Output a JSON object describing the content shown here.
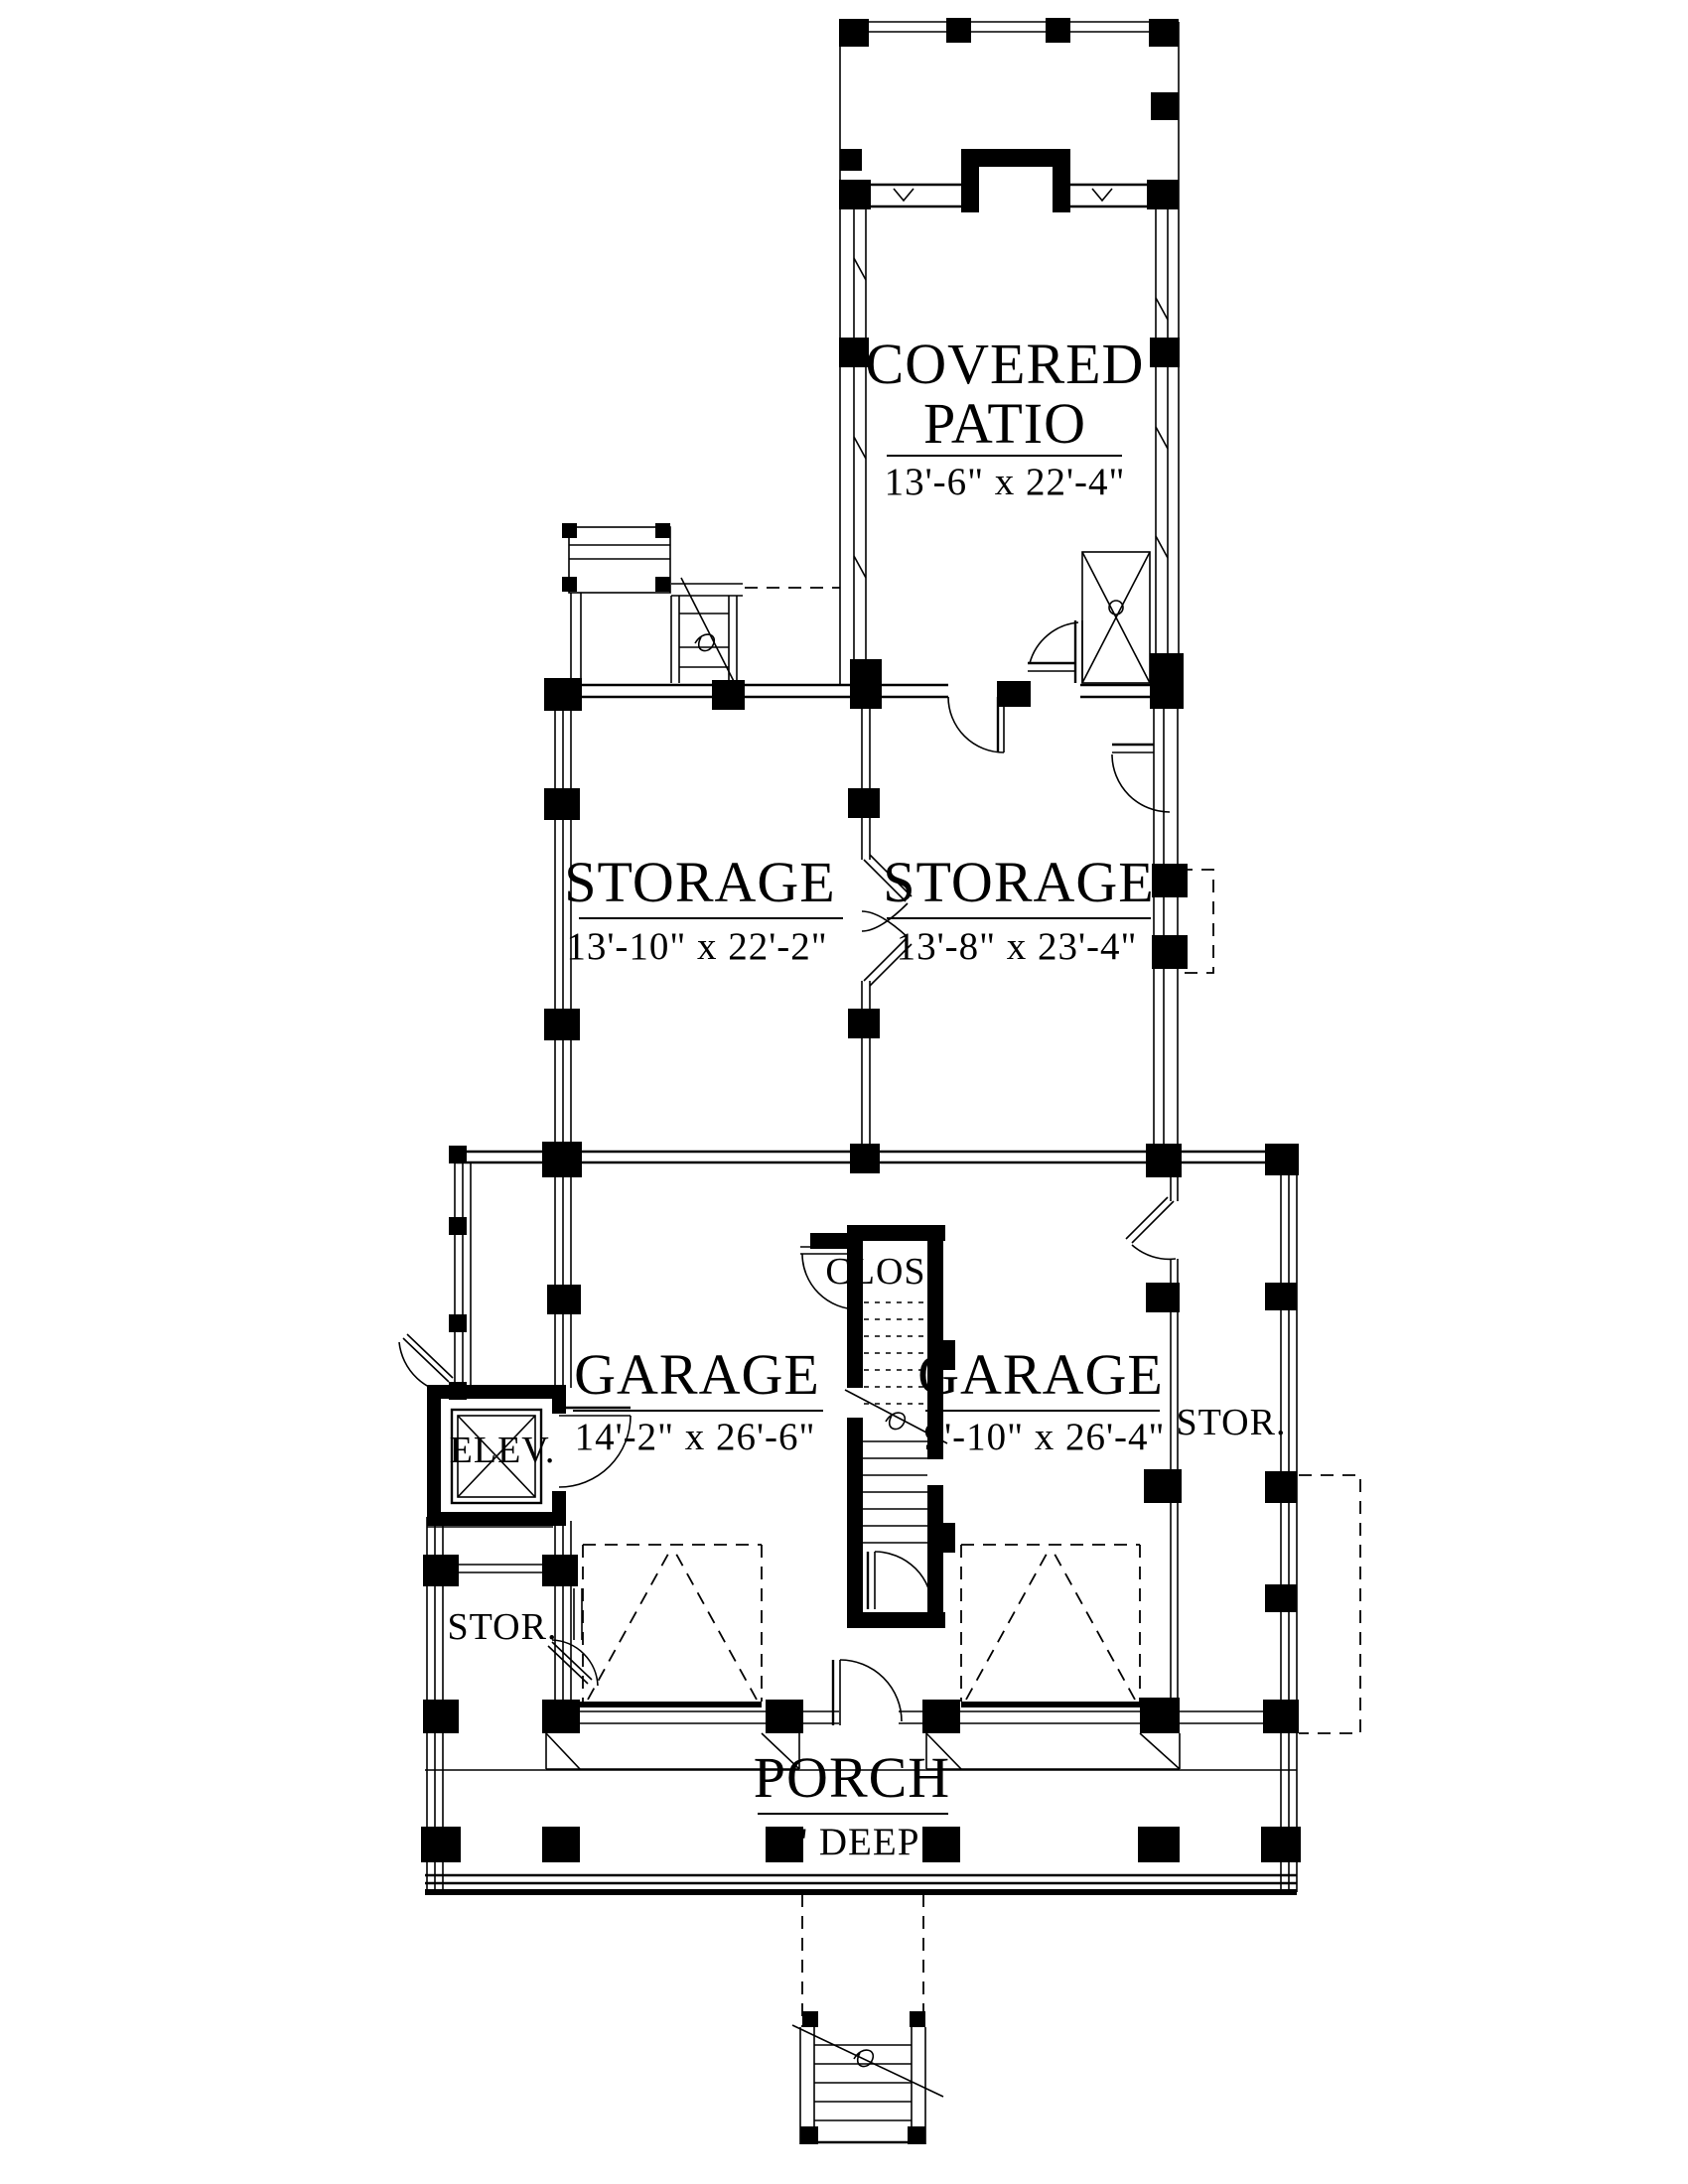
{
  "plan": {
    "rooms": {
      "covered_patio": {
        "line1": "COVERED",
        "line2": "PATIO",
        "dims": "13'-6\" x 22'-4\""
      },
      "storage_left": {
        "name": "STORAGE",
        "dims": "13'-10\" x 22'-2\""
      },
      "storage_right": {
        "name": "STORAGE",
        "dims": "13'-8\" x 23'-4\""
      },
      "garage_left": {
        "name": "GARAGE",
        "dims": "14'-2\" x 26'-6\""
      },
      "garage_right": {
        "name": "GARAGE",
        "dims": "9'-10\" x 26'-4\""
      },
      "closet": {
        "name": "CLOS"
      },
      "elevator": {
        "name": "ELEV."
      },
      "stor_right": {
        "name": "STOR."
      },
      "stor_left": {
        "name": "STOR."
      },
      "porch": {
        "name": "PORCH",
        "dims": "8' DEEP"
      }
    },
    "line_color": "#000000",
    "background": "#ffffff"
  }
}
